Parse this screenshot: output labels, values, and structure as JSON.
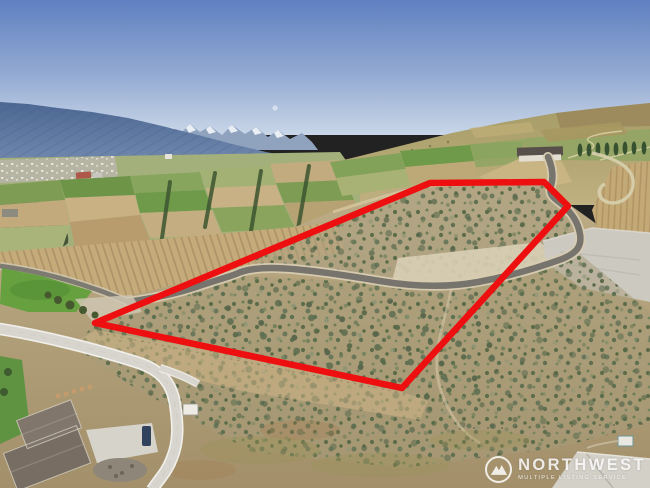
{
  "watermark": {
    "brand": "NORTHWEST",
    "tagline": "MULTIPLE LISTING SERVICE"
  },
  "annotation": {
    "type": "property-boundary-outline",
    "boundary_color": "#ee1010"
  },
  "scene": {
    "description": "Aerial drone photo of a vacant sagebrush parcel outlined in red, bordered by a winding paved road, orchards and vineyards in a valley, new homes under construction at lower left, and blue-hazed mountains with snowy peaks under a clear blue sky",
    "sky_top": "#5f80c1",
    "sky_horizon": "#c9d6e8",
    "mountains": "#4c6793",
    "sagebrush": "#5f7050",
    "orchard_green": "#6e9a49",
    "asphalt_road": "#77746d",
    "concrete_road": "#d8d5cf"
  }
}
